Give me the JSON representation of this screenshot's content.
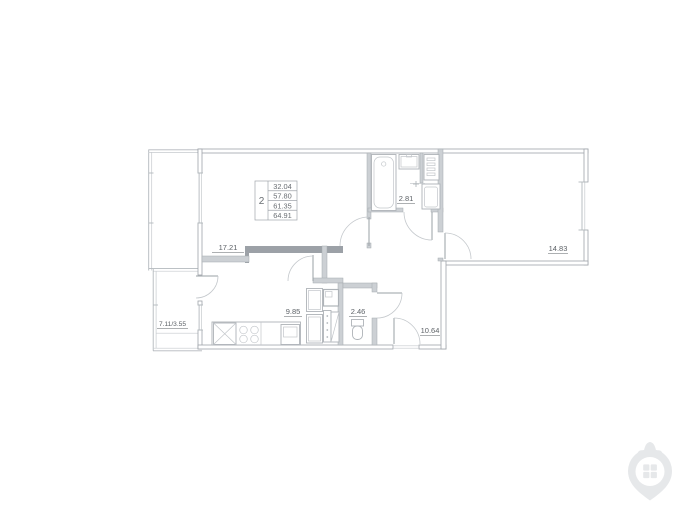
{
  "plan": {
    "stamp": {
      "room_count": "2",
      "areas": [
        "32.04",
        "57.80",
        "61.35",
        "64.91"
      ]
    },
    "labels": {
      "living_area": "17.21",
      "bathroom_area": "2.81",
      "bedroom_area": "14.83",
      "kitchen_area": "9.85",
      "wc_area": "2.46",
      "hall_area": "10.64",
      "balcony_area": "7.11/3.55"
    },
    "colors": {
      "line": "#b3b8bd",
      "wall_fill": "#ccd0d4",
      "wall_dark": "#9ca1a7",
      "text": "#5d6267",
      "watermark": "#e6e8ea"
    }
  }
}
